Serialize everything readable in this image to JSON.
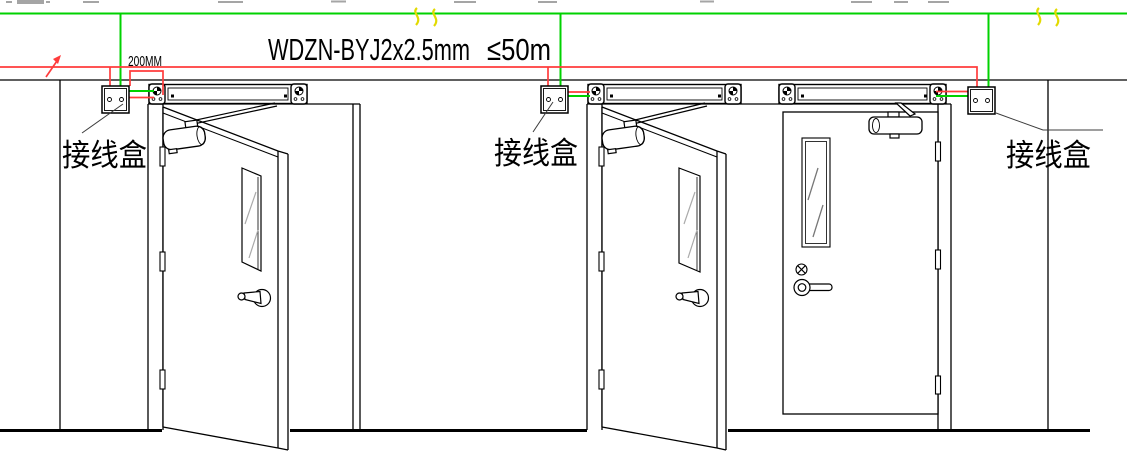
{
  "labels": {
    "offset_dimension": "200MM",
    "cable_spec": "WDZN-BYJ2x2.5mm",
    "cable_max_length": "≤50m"
  },
  "junction_boxes": [
    {
      "label": "接线盒"
    },
    {
      "label": "接线盒"
    },
    {
      "label": "接线盒"
    }
  ],
  "colors": {
    "power_line_green": "#00d200",
    "signal_line_red": "#ff3c3c",
    "break_mark_yellow": "#e2da00",
    "linework_black": "#000000",
    "leader_gray": "#3c3c3c"
  }
}
